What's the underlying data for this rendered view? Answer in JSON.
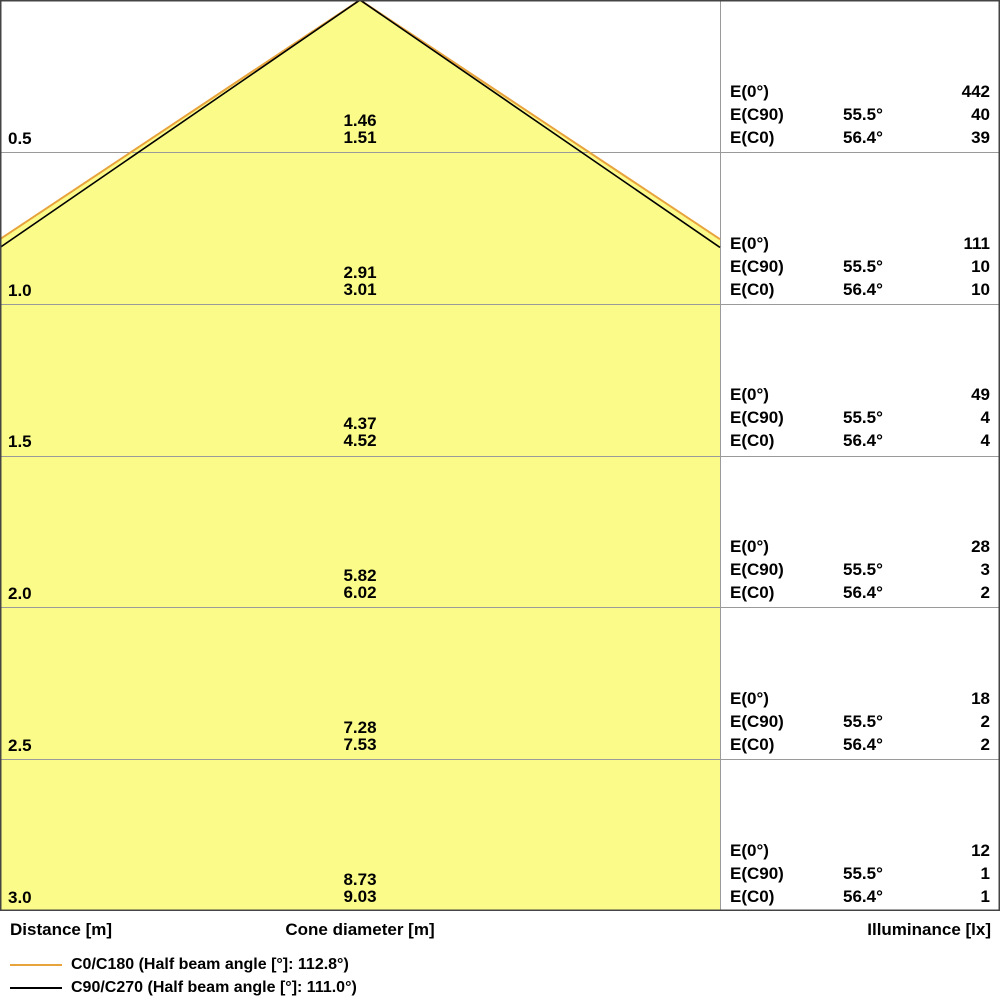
{
  "colors": {
    "cone_fill": "#FBFB8A",
    "c0_line": "#E8A33D",
    "c90_line": "#000000",
    "gridline": "#9a9a9a",
    "border": "#444444",
    "text": "#000000"
  },
  "e_labels": {
    "e0": "E(0°)",
    "e90": "E(C90)",
    "ec0": "E(C0)"
  },
  "angles": {
    "e90": "55.5°",
    "ec0": "56.4°",
    "e0": ""
  },
  "rows": [
    {
      "distance": "0.5",
      "cone_c90": "1.46",
      "cone_c0": "1.51",
      "e0": "442",
      "e90": "40",
      "ec0": "39"
    },
    {
      "distance": "1.0",
      "cone_c90": "2.91",
      "cone_c0": "3.01",
      "e0": "111",
      "e90": "10",
      "ec0": "10"
    },
    {
      "distance": "1.5",
      "cone_c90": "4.37",
      "cone_c0": "4.52",
      "e0": "49",
      "e90": "4",
      "ec0": "4"
    },
    {
      "distance": "2.0",
      "cone_c90": "5.82",
      "cone_c0": "6.02",
      "e0": "28",
      "e90": "3",
      "ec0": "2"
    },
    {
      "distance": "2.5",
      "cone_c90": "7.28",
      "cone_c0": "7.53",
      "e0": "18",
      "e90": "2",
      "ec0": "2"
    },
    {
      "distance": "3.0",
      "cone_c90": "8.73",
      "cone_c0": "9.03",
      "e0": "12",
      "e90": "1",
      "ec0": "1"
    }
  ],
  "footer": {
    "distance_label": "Distance [m]",
    "cone_label": "Cone diameter [m]",
    "illuminance_label": "Illuminance [lx]"
  },
  "legend": {
    "items": [
      {
        "label": "C0/C180 (Half beam angle [°]: 112.8°)",
        "color": "#E8A33D"
      },
      {
        "label": "C90/C270 (Half beam angle [°]: 111.0°)",
        "color": "#000000"
      }
    ]
  },
  "chart_data": {
    "type": "area",
    "title": "Luminaire light cone diagram",
    "xlabel": "Cone diameter [m]",
    "ylabel": "Distance [m]",
    "ylabel_right": "Illuminance [lx]",
    "distances_m": [
      0.5,
      1.0,
      1.5,
      2.0,
      2.5,
      3.0
    ],
    "e0_illuminance_lx": [
      442,
      111,
      49,
      28,
      18,
      12
    ],
    "series": [
      {
        "name": "C0/C180",
        "half_beam_angle_deg": 112.8,
        "half_angle_deg": 56.4,
        "cone_diameter_m": [
          1.51,
          3.01,
          4.52,
          6.02,
          7.53,
          9.03
        ],
        "illuminance_lx": [
          39,
          10,
          4,
          2,
          2,
          1
        ],
        "color": "#E8A33D"
      },
      {
        "name": "C90/C270",
        "half_beam_angle_deg": 111.0,
        "half_angle_deg": 55.5,
        "cone_diameter_m": [
          1.46,
          2.91,
          4.37,
          5.82,
          7.28,
          8.73
        ],
        "illuminance_lx": [
          40,
          10,
          4,
          3,
          2,
          1
        ],
        "color": "#000000"
      }
    ],
    "grid": true,
    "legend_position": "bottom-left"
  }
}
